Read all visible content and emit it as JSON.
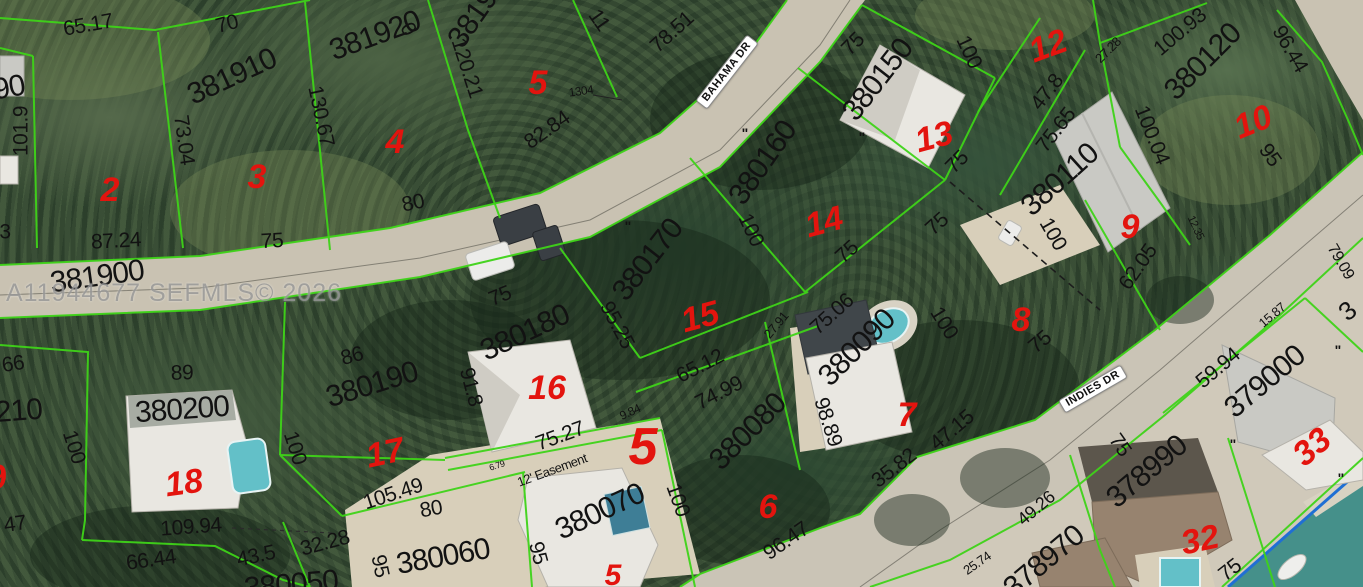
{
  "watermark": {
    "text": "A11944677 SEFMLS© 2026"
  },
  "streets": [
    {
      "t": "BAHAMA DR",
      "x": 727,
      "y": 72,
      "r": -52
    },
    {
      "t": "INDIES DR",
      "x": 1093,
      "y": 389,
      "r": -30
    }
  ],
  "parcel_numbers": [
    {
      "t": "381900",
      "x": 97,
      "y": 277,
      "r": -8
    },
    {
      "t": "381910",
      "x": 232,
      "y": 77,
      "r": -25
    },
    {
      "t": "381920",
      "x": 375,
      "y": 36,
      "r": -20
    },
    {
      "t": "381930",
      "x": 482,
      "y": 6,
      "r": -55
    },
    {
      "t": "380150",
      "x": 878,
      "y": 80,
      "r": -52
    },
    {
      "t": "380160",
      "x": 763,
      "y": 163,
      "r": -55
    },
    {
      "t": "380170",
      "x": 648,
      "y": 260,
      "r": -52
    },
    {
      "t": "380180",
      "x": 525,
      "y": 333,
      "r": -25
    },
    {
      "t": "380190",
      "x": 372,
      "y": 385,
      "r": -17
    },
    {
      "t": "380200",
      "x": 182,
      "y": 410,
      "r": -4
    },
    {
      "t": "380210",
      "x": -5,
      "y": 413,
      "r": -4
    },
    {
      "t": "380090",
      "x": 857,
      "y": 348,
      "r": -45
    },
    {
      "t": "380080",
      "x": 748,
      "y": 432,
      "r": -45
    },
    {
      "t": "380110",
      "x": 1060,
      "y": 180,
      "r": -42
    },
    {
      "t": "380120",
      "x": 1203,
      "y": 62,
      "r": -45
    },
    {
      "t": "379000",
      "x": 1265,
      "y": 382,
      "r": -40
    },
    {
      "t": "378990",
      "x": 1147,
      "y": 472,
      "r": -40
    },
    {
      "t": "378970",
      "x": 1044,
      "y": 562,
      "r": -40
    },
    {
      "t": "380060",
      "x": 443,
      "y": 557,
      "r": -10
    },
    {
      "t": "380070",
      "x": 600,
      "y": 512,
      "r": -25
    },
    {
      "t": "380050",
      "x": 291,
      "y": 585,
      "r": -5
    },
    {
      "t": "90",
      "x": 9,
      "y": 88,
      "r": -10
    },
    {
      "t": "3",
      "x": 1347,
      "y": 311,
      "r": -40,
      "s": 26
    }
  ],
  "lot_numbers": [
    {
      "t": "2",
      "x": 110,
      "y": 190,
      "r": 0
    },
    {
      "t": "3",
      "x": 257,
      "y": 177,
      "r": 0
    },
    {
      "t": "4",
      "x": 395,
      "y": 142,
      "r": 0
    },
    {
      "t": "5",
      "x": 538,
      "y": 83,
      "r": 0
    },
    {
      "t": "12",
      "x": 1048,
      "y": 46,
      "r": -20
    },
    {
      "t": "13",
      "x": 934,
      "y": 137,
      "r": -15
    },
    {
      "t": "14",
      "x": 824,
      "y": 222,
      "r": -15
    },
    {
      "t": "10",
      "x": 1253,
      "y": 122,
      "r": -22
    },
    {
      "t": "9",
      "x": 1130,
      "y": 227,
      "r": 0
    },
    {
      "t": "8",
      "x": 1021,
      "y": 320,
      "r": 0
    },
    {
      "t": "15",
      "x": 700,
      "y": 317,
      "r": -15
    },
    {
      "t": "16",
      "x": 547,
      "y": 388,
      "r": 0
    },
    {
      "t": "7",
      "x": 907,
      "y": 415,
      "r": 0
    },
    {
      "t": "17",
      "x": 385,
      "y": 453,
      "r": -12
    },
    {
      "t": "18",
      "x": 184,
      "y": 483,
      "r": -8
    },
    {
      "t": "6",
      "x": 768,
      "y": 507,
      "r": 0
    },
    {
      "t": "5",
      "x": 643,
      "y": 447,
      "r": 0,
      "s": 52
    },
    {
      "t": "5",
      "x": 613,
      "y": 576,
      "r": 0,
      "s": 30
    },
    {
      "t": "32",
      "x": 1200,
      "y": 540,
      "r": -12
    },
    {
      "t": "33",
      "x": 1312,
      "y": 447,
      "r": -40
    },
    {
      "t": "19",
      "x": -12,
      "y": 479,
      "r": -10
    }
  ],
  "dimensions": [
    {
      "t": "65.17",
      "x": 88,
      "y": 25,
      "r": -10
    },
    {
      "t": "70",
      "x": 227,
      "y": 24,
      "r": -15
    },
    {
      "t": "87.24",
      "x": 116,
      "y": 241,
      "r": -3
    },
    {
      "t": "75",
      "x": 272,
      "y": 241,
      "r": -3
    },
    {
      "t": "80",
      "x": 413,
      "y": 203,
      "r": -12
    },
    {
      "t": "82.84",
      "x": 547,
      "y": 130,
      "r": -35
    },
    {
      "t": "120.21",
      "x": 467,
      "y": 68,
      "r": 72
    },
    {
      "t": "78.51",
      "x": 672,
      "y": 32,
      "r": -42
    },
    {
      "t": "1304",
      "x": 581,
      "y": 91,
      "r": -8,
      "s": 12
    },
    {
      "t": "75",
      "x": 853,
      "y": 44,
      "r": -45
    },
    {
      "t": "100",
      "x": 969,
      "y": 52,
      "r": 65
    },
    {
      "t": "75",
      "x": 957,
      "y": 162,
      "r": -45
    },
    {
      "t": "75",
      "x": 937,
      "y": 224,
      "r": -42
    },
    {
      "t": "100",
      "x": 751,
      "y": 230,
      "r": 65
    },
    {
      "t": "75",
      "x": 847,
      "y": 252,
      "r": -42
    },
    {
      "t": "95.25",
      "x": 617,
      "y": 325,
      "r": 62
    },
    {
      "t": "65.12",
      "x": 700,
      "y": 366,
      "r": -27
    },
    {
      "t": "74.99",
      "x": 719,
      "y": 393,
      "r": -27
    },
    {
      "t": "27.91",
      "x": 776,
      "y": 325,
      "r": -50,
      "s": 13
    },
    {
      "t": "75.06",
      "x": 832,
      "y": 314,
      "r": -42
    },
    {
      "t": "100",
      "x": 944,
      "y": 323,
      "r": 58
    },
    {
      "t": "47.15",
      "x": 952,
      "y": 430,
      "r": -40
    },
    {
      "t": "98.89",
      "x": 828,
      "y": 422,
      "r": 72
    },
    {
      "t": "35.82",
      "x": 894,
      "y": 468,
      "r": -38
    },
    {
      "t": "96.47",
      "x": 786,
      "y": 541,
      "r": -35
    },
    {
      "t": "25.74",
      "x": 977,
      "y": 563,
      "r": -35,
      "s": 13
    },
    {
      "t": "49.26",
      "x": 1036,
      "y": 508,
      "r": -40,
      "s": 18
    },
    {
      "t": "62.05",
      "x": 1138,
      "y": 267,
      "r": -55
    },
    {
      "t": "100",
      "x": 1053,
      "y": 234,
      "r": 60
    },
    {
      "t": "75",
      "x": 1040,
      "y": 342,
      "r": -40
    },
    {
      "t": "75.65",
      "x": 1056,
      "y": 130,
      "r": -52
    },
    {
      "t": "47.8",
      "x": 1047,
      "y": 92,
      "r": -52
    },
    {
      "t": "27.28",
      "x": 1108,
      "y": 50,
      "r": -45,
      "s": 13
    },
    {
      "t": "100.93",
      "x": 1180,
      "y": 32,
      "r": -40
    },
    {
      "t": "96.44",
      "x": 1290,
      "y": 49,
      "r": 60
    },
    {
      "t": "100.04",
      "x": 1152,
      "y": 135,
      "r": 68
    },
    {
      "t": "95",
      "x": 1270,
      "y": 155,
      "r": 55
    },
    {
      "t": "79.09",
      "x": 1340,
      "y": 262,
      "r": 60,
      "s": 16
    },
    {
      "t": "59.94",
      "x": 1218,
      "y": 368,
      "r": -40
    },
    {
      "t": "15.87",
      "x": 1272,
      "y": 315,
      "r": -40,
      "s": 13
    },
    {
      "t": "75",
      "x": 1120,
      "y": 445,
      "r": 55
    },
    {
      "t": "75",
      "x": 1230,
      "y": 570,
      "r": -38
    },
    {
      "t": "105.49",
      "x": 393,
      "y": 494,
      "r": -18
    },
    {
      "t": "109.94",
      "x": 191,
      "y": 527,
      "r": -4
    },
    {
      "t": "66.44",
      "x": 151,
      "y": 560,
      "r": -8
    },
    {
      "t": "43.5",
      "x": 256,
      "y": 556,
      "r": -12
    },
    {
      "t": "32.28",
      "x": 325,
      "y": 543,
      "r": -15
    },
    {
      "t": "80",
      "x": 431,
      "y": 509,
      "r": -10
    },
    {
      "t": "75.27",
      "x": 560,
      "y": 436,
      "r": -20
    },
    {
      "t": "9.84",
      "x": 630,
      "y": 412,
      "r": -25,
      "s": 12
    },
    {
      "t": "100",
      "x": 678,
      "y": 500,
      "r": 70
    },
    {
      "t": "95",
      "x": 538,
      "y": 553,
      "r": 75
    },
    {
      "t": "100",
      "x": 74,
      "y": 447,
      "r": 72
    },
    {
      "t": "100",
      "x": 295,
      "y": 448,
      "r": 72
    },
    {
      "t": "86",
      "x": 352,
      "y": 356,
      "r": -15
    },
    {
      "t": "89",
      "x": 182,
      "y": 373,
      "r": -2
    },
    {
      "t": "91.8",
      "x": 471,
      "y": 387,
      "r": 75
    },
    {
      "t": "66",
      "x": 13,
      "y": 364,
      "r": -8
    },
    {
      "t": "3",
      "x": 5,
      "y": 232,
      "r": 0
    },
    {
      "t": "47",
      "x": 15,
      "y": 524,
      "r": -8
    },
    {
      "t": "101.9",
      "x": 21,
      "y": 131,
      "r": -90
    },
    {
      "t": "130.67",
      "x": 321,
      "y": 116,
      "r": 78
    },
    {
      "t": "73.04",
      "x": 184,
      "y": 140,
      "r": 82
    },
    {
      "t": "11",
      "x": 599,
      "y": 20,
      "r": 55
    },
    {
      "t": "0",
      "x": 408,
      "y": 29,
      "r": 60
    },
    {
      "t": "75",
      "x": 500,
      "y": 296,
      "r": -22
    },
    {
      "t": "95",
      "x": 380,
      "y": 566,
      "r": 78
    },
    {
      "t": "12.35",
      "x": 1195,
      "y": 228,
      "r": 65,
      "s": 11
    },
    {
      "t": "12' Easement",
      "x": 552,
      "y": 470,
      "r": -20,
      "s": 13
    },
    {
      "t": "6.79",
      "x": 497,
      "y": 466,
      "r": -18,
      "s": 9
    }
  ],
  "survey_marks": [
    {
      "t": "\"",
      "x": 745,
      "y": 133,
      "r": 0
    },
    {
      "t": "\"",
      "x": 862,
      "y": 137,
      "r": 0
    },
    {
      "t": "\"",
      "x": 628,
      "y": 226,
      "r": 0
    },
    {
      "t": "\"",
      "x": 1338,
      "y": 350,
      "r": 0
    },
    {
      "t": "\"",
      "x": 1233,
      "y": 444,
      "r": 0
    },
    {
      "t": "\"",
      "x": 1341,
      "y": 478,
      "r": 0
    }
  ],
  "colors": {
    "parcel_line": "#3ed318",
    "lot_red": "#e3140e",
    "dim_text": "#121212",
    "road": "#c9c2b2",
    "road_indies": "#cac4b6",
    "concrete": "#d0c9ba",
    "sand": "#d8cfba",
    "water": "#45908a",
    "seawall_blue": "#1f6fd4",
    "pool_teal": "#63c0c8",
    "roof_white": "#e9e7e1",
    "roof_gray": "#c9c9c4",
    "roof_brown": "#97836f",
    "street_bg": "#ffffff",
    "watermark_gray": "#999999"
  }
}
